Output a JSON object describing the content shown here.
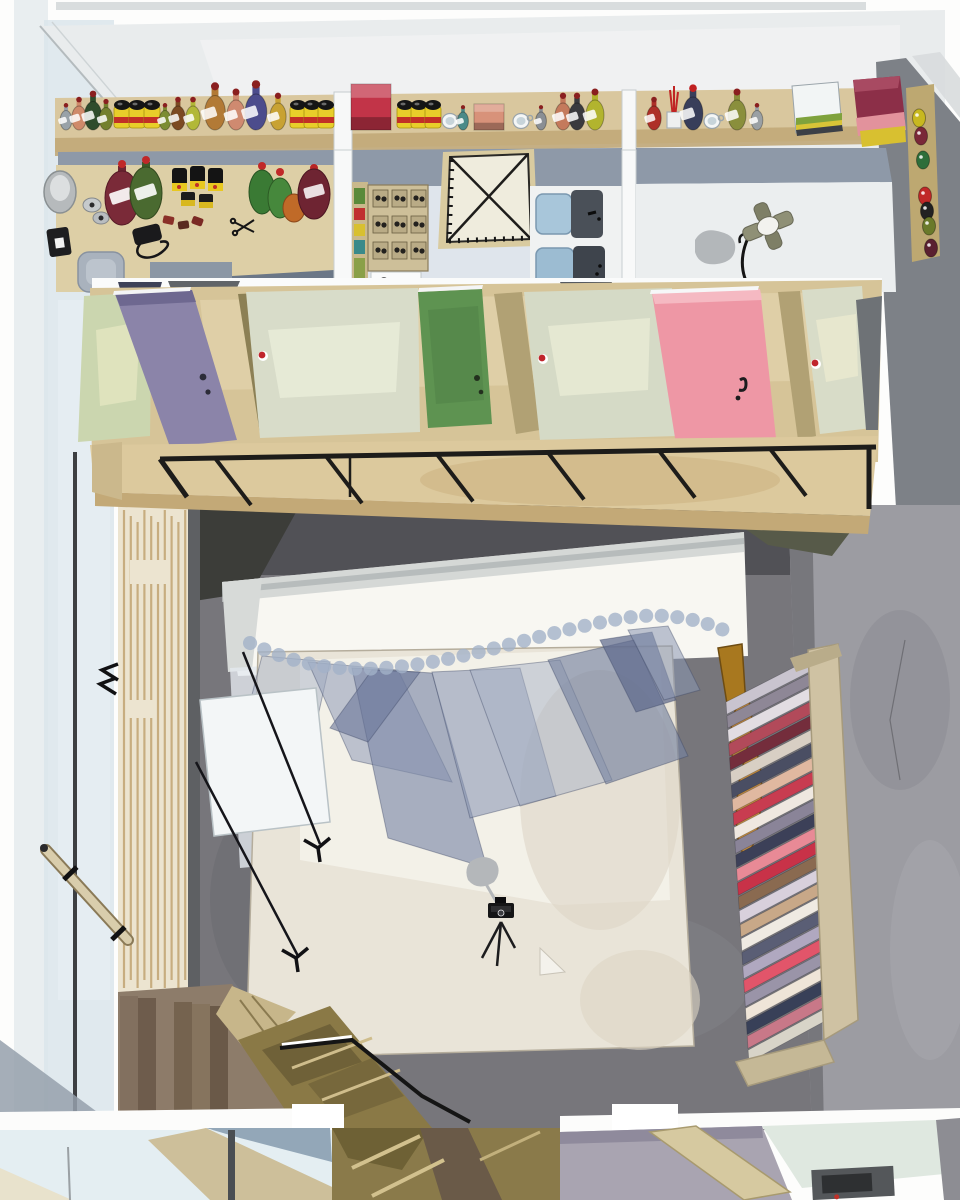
{
  "artwork": {
    "kind": "watercolor-illustration",
    "subject": "top-down cutaway view of an artist and photography studio",
    "text_visible": "none"
  },
  "palette": {
    "paper": "#fdfdfc",
    "margin_wash": "#dce6ea",
    "ceiling": "#e9eced",
    "wall_blue_gray": "#8e99a8",
    "shelf_wood": "#d9c79e",
    "shelf_edge": "#c1a878",
    "counter_wood": "#ddcfa6",
    "room_floor": "#eef0f1",
    "floor_pale_blue": "#dfe5ec",
    "dark_wall": "#7d8187",
    "concrete_wall": "#9c9ca2",
    "studio_floor": "#77767b",
    "studio_floor_shadow": "#515156",
    "backdrop_white": "#f8f7f2",
    "floor_paper": "#e9e4d8",
    "balcony_wood": "#dcc99d",
    "slat_wall": "#ece4d0",
    "slat_line": "#c3a878",
    "door_purple": "#8b84a9",
    "door_green": "#5e9351",
    "door_pink": "#ee97a5",
    "canvas_panel": "#d8dcc9",
    "panel_light_green": "#cbd6af",
    "railing_black": "#1d1c1a",
    "curtain_rod_gold": "#b07a20",
    "curtain_fabric_blue": "#8d98b4",
    "propeller_wood": "#b5813c",
    "rack_frame": "#cfc2a3",
    "stairs_brown": "#8d7c6a",
    "stairs_olive": "#8a7946",
    "lower_floor_blue": "#e4eef2",
    "lower_floor_lavender": "#a9a4b1",
    "camera_black": "#151516",
    "accent_red": "#c0252c",
    "can_yellow": "#e8ce2a"
  },
  "builders": {
    "shelf_items": [
      {
        "x": 66,
        "t": "jar",
        "s": 0.65,
        "c": "#99a2a8"
      },
      {
        "x": 79,
        "t": "jar",
        "s": 0.8,
        "c": "#cf8a6a"
      },
      {
        "x": 93,
        "t": "jar",
        "s": 0.95,
        "c": "#2f4c2c"
      },
      {
        "x": 106,
        "t": "jar",
        "s": 0.75,
        "c": "#74802e"
      },
      {
        "x": 122,
        "t": "can"
      },
      {
        "x": 137,
        "t": "can"
      },
      {
        "x": 152,
        "t": "can"
      },
      {
        "x": 165,
        "t": "jar",
        "s": 0.65,
        "c": "#7c8c33"
      },
      {
        "x": 178,
        "t": "jar",
        "s": 0.8,
        "c": "#7c4a22"
      },
      {
        "x": 193,
        "t": "jar",
        "s": 0.8,
        "c": "#b2b838"
      },
      {
        "x": 215,
        "t": "jar",
        "s": 1.15,
        "c": "#b27a36"
      },
      {
        "x": 236,
        "t": "jar",
        "s": 1.0,
        "c": "#cf8a70"
      },
      {
        "x": 256,
        "t": "jar",
        "s": 1.2,
        "c": "#4c4c8c"
      },
      {
        "x": 278,
        "t": "jar",
        "s": 0.9,
        "c": "#c8a233"
      },
      {
        "x": 298,
        "t": "can"
      },
      {
        "x": 312,
        "t": "can"
      },
      {
        "x": 326,
        "t": "can"
      },
      {
        "x": 371,
        "t": "box",
        "c": "#c23448",
        "w": 40,
        "h": 46
      },
      {
        "x": 405,
        "t": "can"
      },
      {
        "x": 419,
        "t": "can"
      },
      {
        "x": 433,
        "t": "can"
      },
      {
        "x": 450,
        "t": "cup"
      },
      {
        "x": 463,
        "t": "jar",
        "s": 0.6,
        "c": "#4a8a88"
      },
      {
        "x": 489,
        "t": "box",
        "c": "#d8927a",
        "w": 30,
        "h": 26
      },
      {
        "x": 521,
        "t": "cup"
      },
      {
        "x": 541,
        "t": "jar",
        "s": 0.6,
        "c": "#8a8f94"
      },
      {
        "x": 563,
        "t": "jar",
        "s": 0.9,
        "c": "#c47a5c"
      },
      {
        "x": 577,
        "t": "jar",
        "s": 0.9,
        "c": "#3a3a3e"
      },
      {
        "x": 595,
        "t": "jar",
        "s": 1.0,
        "c": "#b2b42e"
      },
      {
        "x": 654,
        "t": "jar",
        "s": 0.8,
        "c": "#ae3028"
      },
      {
        "x": 674,
        "t": "brushes"
      },
      {
        "x": 693,
        "t": "jar",
        "s": 1.1,
        "c": "#383e5a",
        "cap": "#c02020"
      },
      {
        "x": 712,
        "t": "cup"
      },
      {
        "x": 737,
        "t": "jar",
        "s": 1.0,
        "c": "#8a8f3c"
      },
      {
        "x": 757,
        "t": "jar",
        "s": 0.65,
        "c": "#9aa0a4"
      }
    ],
    "wall_rack_bottles": [
      {
        "y": 118,
        "c": "#c8b820"
      },
      {
        "y": 136,
        "c": "#7a2838"
      },
      {
        "y": 160,
        "c": "#2e6e3a"
      },
      {
        "y": 196,
        "c": "#c02828"
      },
      {
        "y": 211,
        "c": "#222222"
      },
      {
        "y": 226,
        "c": "#6a7a2a"
      },
      {
        "y": 248,
        "c": "#5a2030"
      }
    ],
    "railing": {
      "strut_count": 6,
      "x_start": 215,
      "x_step": 111
    },
    "slats": {
      "count": 10,
      "x_start": 124,
      "x_step": 6.8,
      "y_top": 510,
      "y_bottom": 988
    },
    "fabric_rack_stripes": [
      "#c9c4cf",
      "#8e8796",
      "#e2dde2",
      "#b24a5a",
      "#742d3c",
      "#d8cfc4",
      "#4a4e63",
      "#e0b8a0",
      "#c83c50",
      "#efe8e0",
      "#8a8498",
      "#3c4058",
      "#e88a96",
      "#c83248",
      "#8a6a50",
      "#d8d0dc",
      "#c8a888",
      "#efeae2",
      "#5a5e75",
      "#b0a8c0",
      "#e2556a",
      "#9a94a8",
      "#efe5d8",
      "#384058",
      "#c87888",
      "#d8d4c8"
    ],
    "hanging_fabrics": [
      {
        "pts": "262,656 330,662 298,806 228,788",
        "c": "#aeb8ca",
        "o": 0.55
      },
      {
        "pts": "308,662 398,670 452,782 352,760",
        "c": "#97a2bb",
        "o": 0.6
      },
      {
        "pts": "352,668 432,673 487,868 388,838",
        "c": "#7e8aa9",
        "o": 0.65
      },
      {
        "pts": "372,670 420,672 368,742 330,728",
        "c": "#6a769a",
        "o": 0.6
      },
      {
        "pts": "432,672 520,668 556,796 470,818",
        "c": "#8e9ab6",
        "o": 0.6
      },
      {
        "pts": "470,670 560,660 612,780 520,806",
        "c": "#a7b1c6",
        "o": 0.5
      },
      {
        "pts": "548,660 634,640 688,756 606,784",
        "c": "#76829f",
        "o": 0.65
      },
      {
        "pts": "600,640 652,632 676,700 636,712",
        "c": "#5d688c",
        "o": 0.7
      },
      {
        "pts": "628,630 668,626 700,690 664,700",
        "c": "#8b97b2",
        "o": 0.55
      }
    ]
  }
}
